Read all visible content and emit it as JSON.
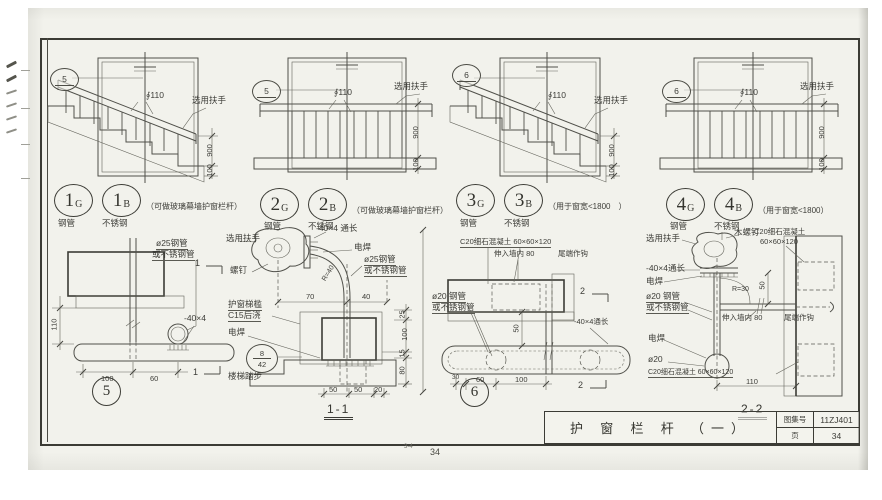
{
  "sheet": {
    "atlas_title": "护 窗 栏 杆 （一）",
    "atlas_label": "图集号",
    "atlas_no": "11ZJ401",
    "page_label": "页",
    "page_no": "34",
    "footer_mark": "3-4",
    "footer_page": "34"
  },
  "elevations": [
    {
      "bubble": "5",
      "tag1": {
        "num": "1",
        "sub": "G"
      },
      "tag2": {
        "num": "1",
        "sub": "B"
      },
      "cap1": "钢管",
      "cap2": "不锈钢",
      "note": "（可做玻璃幕墙护窗栏杆）",
      "handrail": "选用扶手",
      "spacing": "∮110",
      "dim_height": "900",
      "dim_base": "100"
    },
    {
      "bubble": "5",
      "tag1": {
        "num": "2",
        "sub": "G"
      },
      "tag2": {
        "num": "2",
        "sub": "B"
      },
      "cap1": "钢管",
      "cap2": "不锈钢",
      "note": "（可做玻璃幕墙护窗栏杆）",
      "handrail": "选用扶手",
      "spacing": "∮110",
      "dim_height": "900",
      "dim_base": "100"
    },
    {
      "bubble": "6",
      "tag1": {
        "num": "3",
        "sub": "G"
      },
      "tag2": {
        "num": "3",
        "sub": "B"
      },
      "cap1": "钢管",
      "cap2": "不锈钢",
      "note": "（用于窗宽<1800　）",
      "handrail": "选用扶手",
      "spacing": "∮110",
      "dim_height": "900",
      "dim_base": "100"
    },
    {
      "bubble": "6",
      "tag1": {
        "num": "4",
        "sub": "G"
      },
      "tag2": {
        "num": "4",
        "sub": "B"
      },
      "cap1": "钢管",
      "cap2": "不锈钢",
      "note": "（用于窗宽<1800）",
      "handrail": "选用扶手",
      "spacing": "∮110",
      "dim_height": "900",
      "dim_base": "100"
    }
  ],
  "detail5": {
    "num": "5",
    "pipe_line1": "ø25钢管",
    "pipe_line2": "或不锈钢管",
    "flat": "-40×4",
    "dim_height": "110",
    "dim_w1": "100",
    "dim_w2": "60",
    "section_mark": "1"
  },
  "section_1_1": {
    "title": "1-1",
    "handrail": "选用扶手",
    "flat": "-40×4 通长",
    "weld_top": "电焊",
    "pipe_line1": "ø25钢管",
    "pipe_line2": "或不锈钢管",
    "screw": "螺钉",
    "radius": "R=40",
    "dim_70": "70",
    "dim_40": "40",
    "sill_line1": "护窗梯槛",
    "sill_line2": "C15后浇",
    "weld_bottom": "电焊",
    "tread": "楼梯踏步",
    "ref_top": "8",
    "ref_bottom": "42",
    "dim_25": "25",
    "dim_100": "100",
    "dim_15": "15",
    "dim_80": "80",
    "dim_b1": "50",
    "dim_b2": "50",
    "dim_b3": "20"
  },
  "detail6": {
    "num": "6",
    "concrete": "C20细石混凝土 60×60×120",
    "embed": "伸入墙内 80",
    "hook": "尾端作钩",
    "pipe_line1": "ø20 钢管",
    "pipe_line2": "或不锈钢管",
    "flat": "-40×4通长",
    "dim_30": "30",
    "dim_60": "60",
    "dim_100": "100",
    "dim_50": "50",
    "section_mark": "2"
  },
  "section_2_2": {
    "title": "2-2",
    "handrail": "选用扶手",
    "wood_screw": "木螺钉",
    "concrete_line1": "C20细石混凝土",
    "concrete_line2": "60×60×120",
    "flat": "-40×4通长",
    "weld_top": "电焊",
    "radius": "R=30",
    "dim_50": "50",
    "pipe_line1": "ø20 钢管",
    "pipe_line2": "或不锈钢管",
    "embed": "伸入墙内 80",
    "hook": "尾端作钩",
    "weld_bottom": "电焊",
    "pipe_dia": "ø20",
    "concrete_bottom": "C20细石混凝土 60×60×120",
    "dim_110": "110"
  }
}
